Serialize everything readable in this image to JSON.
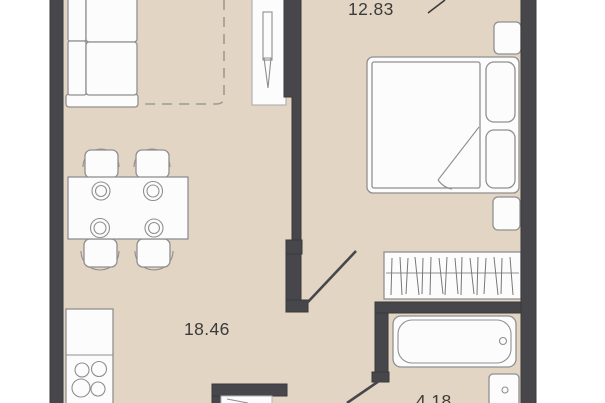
{
  "plan": {
    "type": "apartment-floor-plan",
    "rooms": [
      {
        "id": "bedroom",
        "area_label": "12.83"
      },
      {
        "id": "living-kitchen",
        "area_label": "18.46"
      },
      {
        "id": "bathroom",
        "area_label": "4.18"
      }
    ],
    "furniture": [
      "sofa",
      "dining-table",
      "plates",
      "chairs",
      "kitchen-counter",
      "stove-burners",
      "double-bed",
      "pillows",
      "blanket-fold",
      "nightstands",
      "wardrobe-hanging-rail",
      "bathtub",
      "wash-basin",
      "door-leaf",
      "door-swing-lines"
    ],
    "colors": {
      "bg": "#ffffff",
      "floor": "#e3d5c3",
      "wall": "#47474b",
      "wall-edge": "#39393c",
      "furn-fill": "#fcfcfc",
      "furn-stroke": "#8f8f8f",
      "hatch": "#77777a",
      "dash": "#9b9b93",
      "text": "#3b3b3b"
    }
  }
}
